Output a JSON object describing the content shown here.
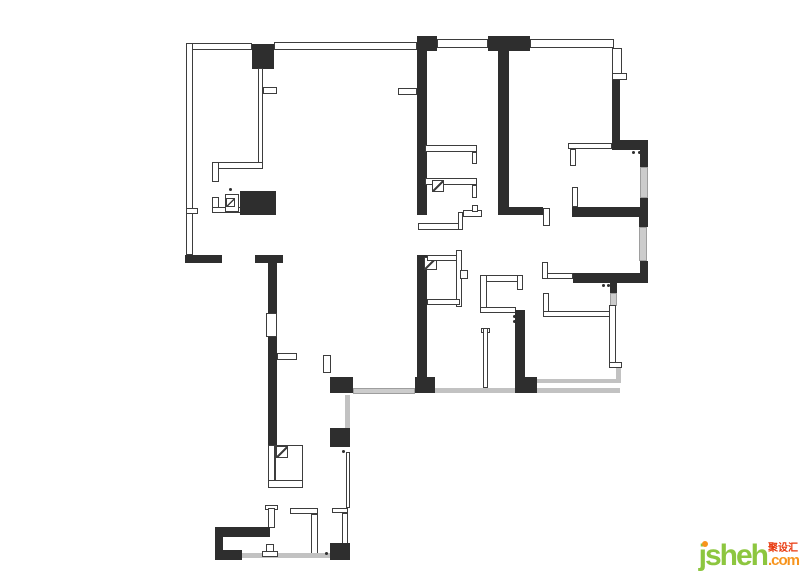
{
  "meta": {
    "width": 800,
    "height": 571,
    "background": "#ffffff",
    "description": "apartment floor plan drawing"
  },
  "floorplan": {
    "colors": {
      "wall": "#2e2e2e",
      "thin_border": "#3d3d3d",
      "window_fill": "#cccccc",
      "window_border": "#9e9e9e",
      "line": "#c2c2c2"
    },
    "shapes": [
      {
        "x": 186,
        "y": 43,
        "w": 66,
        "h": 7,
        "t": "t"
      },
      {
        "x": 186,
        "y": 43,
        "w": 7,
        "h": 212,
        "t": "t"
      },
      {
        "x": 186,
        "y": 208,
        "w": 12,
        "h": 6,
        "t": "t"
      },
      {
        "x": 252,
        "y": 44,
        "w": 22,
        "h": 25,
        "t": "b"
      },
      {
        "x": 274,
        "y": 42,
        "w": 143,
        "h": 8,
        "t": "t"
      },
      {
        "x": 417,
        "y": 36,
        "w": 20,
        "h": 15,
        "t": "b"
      },
      {
        "x": 417,
        "y": 51,
        "w": 10,
        "h": 164,
        "t": "b"
      },
      {
        "x": 437,
        "y": 39,
        "w": 51,
        "h": 9,
        "t": "t"
      },
      {
        "x": 488,
        "y": 36,
        "w": 42,
        "h": 15,
        "t": "b"
      },
      {
        "x": 498,
        "y": 51,
        "w": 11,
        "h": 156,
        "t": "b"
      },
      {
        "x": 530,
        "y": 39,
        "w": 84,
        "h": 9,
        "t": "t"
      },
      {
        "x": 612,
        "y": 48,
        "w": 10,
        "h": 26,
        "t": "t"
      },
      {
        "x": 612,
        "y": 73,
        "w": 15,
        "h": 7,
        "t": "t"
      },
      {
        "x": 612,
        "y": 80,
        "w": 8,
        "h": 61,
        "t": "b"
      },
      {
        "x": 612,
        "y": 140,
        "w": 36,
        "h": 10,
        "t": "b"
      },
      {
        "x": 568,
        "y": 143,
        "w": 44,
        "h": 6,
        "t": "t"
      },
      {
        "x": 570,
        "y": 149,
        "w": 6,
        "h": 17,
        "t": "t"
      },
      {
        "x": 632,
        "y": 151,
        "w": 3,
        "h": 3,
        "t": "dot"
      },
      {
        "x": 638,
        "y": 151,
        "w": 3,
        "h": 3,
        "t": "dot"
      },
      {
        "x": 640,
        "y": 150,
        "w": 8,
        "h": 17,
        "t": "b"
      },
      {
        "x": 640,
        "y": 167,
        "w": 8,
        "h": 31,
        "t": "w"
      },
      {
        "x": 640,
        "y": 198,
        "w": 8,
        "h": 19,
        "t": "b"
      },
      {
        "x": 572,
        "y": 187,
        "w": 6,
        "h": 20,
        "t": "t"
      },
      {
        "x": 572,
        "y": 207,
        "w": 76,
        "h": 10,
        "t": "b"
      },
      {
        "x": 498,
        "y": 207,
        "w": 45,
        "h": 8,
        "t": "b"
      },
      {
        "x": 543,
        "y": 208,
        "w": 7,
        "h": 18,
        "t": "t"
      },
      {
        "x": 639,
        "y": 217,
        "w": 9,
        "h": 10,
        "t": "b"
      },
      {
        "x": 639,
        "y": 227,
        "w": 8,
        "h": 34,
        "t": "w"
      },
      {
        "x": 640,
        "y": 261,
        "w": 8,
        "h": 22,
        "t": "b"
      },
      {
        "x": 573,
        "y": 273,
        "w": 74,
        "h": 10,
        "t": "b"
      },
      {
        "x": 547,
        "y": 273,
        "w": 26,
        "h": 6,
        "t": "t"
      },
      {
        "x": 542,
        "y": 262,
        "w": 6,
        "h": 17,
        "t": "t"
      },
      {
        "x": 602,
        "y": 284,
        "w": 3,
        "h": 3,
        "t": "dot"
      },
      {
        "x": 607,
        "y": 284,
        "w": 3,
        "h": 3,
        "t": "dot"
      },
      {
        "x": 610,
        "y": 283,
        "w": 7,
        "h": 10,
        "t": "b"
      },
      {
        "x": 610,
        "y": 293,
        "w": 7,
        "h": 13,
        "t": "w"
      },
      {
        "x": 543,
        "y": 293,
        "w": 6,
        "h": 23,
        "t": "t"
      },
      {
        "x": 543,
        "y": 311,
        "w": 68,
        "h": 6,
        "t": "t"
      },
      {
        "x": 609,
        "y": 305,
        "w": 7,
        "h": 58,
        "t": "t"
      },
      {
        "x": 609,
        "y": 362,
        "w": 13,
        "h": 6,
        "t": "t"
      },
      {
        "x": 616,
        "y": 368,
        "w": 5,
        "h": 15,
        "t": "g"
      },
      {
        "x": 537,
        "y": 379,
        "w": 83,
        "h": 4,
        "t": "g"
      },
      {
        "x": 537,
        "y": 388,
        "w": 83,
        "h": 5,
        "t": "g"
      },
      {
        "x": 353,
        "y": 388,
        "w": 62,
        "h": 6,
        "t": "w"
      },
      {
        "x": 435,
        "y": 388,
        "w": 82,
        "h": 5,
        "t": "g"
      },
      {
        "x": 415,
        "y": 377,
        "w": 20,
        "h": 16,
        "t": "b"
      },
      {
        "x": 417,
        "y": 255,
        "w": 10,
        "h": 122,
        "t": "b"
      },
      {
        "x": 424,
        "y": 257,
        "w": 13,
        "h": 13,
        "t": "d"
      },
      {
        "x": 427,
        "y": 255,
        "w": 33,
        "h": 6,
        "t": "t"
      },
      {
        "x": 456,
        "y": 250,
        "w": 6,
        "h": 57,
        "t": "t"
      },
      {
        "x": 460,
        "y": 270,
        "w": 8,
        "h": 9,
        "t": "t"
      },
      {
        "x": 427,
        "y": 299,
        "w": 33,
        "h": 6,
        "t": "t"
      },
      {
        "x": 423,
        "y": 180,
        "w": 3,
        "h": 3,
        "t": "dot"
      },
      {
        "x": 423,
        "y": 185,
        "w": 3,
        "h": 3,
        "t": "dot"
      },
      {
        "x": 425,
        "y": 145,
        "w": 52,
        "h": 7,
        "t": "t"
      },
      {
        "x": 472,
        "y": 152,
        "w": 5,
        "h": 12,
        "t": "t"
      },
      {
        "x": 425,
        "y": 178,
        "w": 52,
        "h": 7,
        "t": "t"
      },
      {
        "x": 472,
        "y": 185,
        "w": 5,
        "h": 13,
        "t": "t"
      },
      {
        "x": 432,
        "y": 180,
        "w": 12,
        "h": 12,
        "t": "d"
      },
      {
        "x": 418,
        "y": 223,
        "w": 45,
        "h": 7,
        "t": "t"
      },
      {
        "x": 458,
        "y": 212,
        "w": 5,
        "h": 18,
        "t": "t"
      },
      {
        "x": 463,
        "y": 210,
        "w": 19,
        "h": 7,
        "t": "t"
      },
      {
        "x": 472,
        "y": 205,
        "w": 6,
        "h": 7,
        "t": "t"
      },
      {
        "x": 480,
        "y": 275,
        "w": 43,
        "h": 7,
        "t": "t"
      },
      {
        "x": 480,
        "y": 275,
        "w": 7,
        "h": 37,
        "t": "t"
      },
      {
        "x": 517,
        "y": 275,
        "w": 6,
        "h": 15,
        "t": "t"
      },
      {
        "x": 480,
        "y": 307,
        "w": 36,
        "h": 6,
        "t": "t"
      },
      {
        "x": 515,
        "y": 310,
        "w": 10,
        "h": 67,
        "t": "b"
      },
      {
        "x": 513,
        "y": 315,
        "w": 3,
        "h": 3,
        "t": "dot"
      },
      {
        "x": 513,
        "y": 320,
        "w": 3,
        "h": 3,
        "t": "dot"
      },
      {
        "x": 515,
        "y": 377,
        "w": 22,
        "h": 16,
        "t": "b"
      },
      {
        "x": 481,
        "y": 328,
        "w": 9,
        "h": 5,
        "t": "t"
      },
      {
        "x": 483,
        "y": 328,
        "w": 5,
        "h": 60,
        "t": "t"
      },
      {
        "x": 330,
        "y": 377,
        "w": 23,
        "h": 16,
        "t": "b"
      },
      {
        "x": 323,
        "y": 355,
        "w": 8,
        "h": 18,
        "t": "t"
      },
      {
        "x": 185,
        "y": 255,
        "w": 37,
        "h": 8,
        "t": "b"
      },
      {
        "x": 255,
        "y": 255,
        "w": 28,
        "h": 8,
        "t": "b"
      },
      {
        "x": 268,
        "y": 263,
        "w": 9,
        "h": 50,
        "t": "b"
      },
      {
        "x": 266,
        "y": 313,
        "w": 11,
        "h": 24,
        "t": "t"
      },
      {
        "x": 268,
        "y": 337,
        "w": 9,
        "h": 110,
        "t": "b"
      },
      {
        "x": 277,
        "y": 353,
        "w": 20,
        "h": 7,
        "t": "t"
      },
      {
        "x": 258,
        "y": 68,
        "w": 5,
        "h": 95,
        "t": "t"
      },
      {
        "x": 263,
        "y": 87,
        "w": 14,
        "h": 7,
        "t": "t"
      },
      {
        "x": 398,
        "y": 88,
        "w": 19,
        "h": 7,
        "t": "t"
      },
      {
        "x": 212,
        "y": 162,
        "w": 51,
        "h": 7,
        "t": "t"
      },
      {
        "x": 212,
        "y": 162,
        "w": 7,
        "h": 20,
        "t": "t"
      },
      {
        "x": 212,
        "y": 197,
        "w": 7,
        "h": 16,
        "t": "t"
      },
      {
        "x": 212,
        "y": 207,
        "w": 30,
        "h": 6,
        "t": "t"
      },
      {
        "x": 225,
        "y": 194,
        "w": 14,
        "h": 18,
        "t": "t"
      },
      {
        "x": 226,
        "y": 198,
        "w": 9,
        "h": 9,
        "t": "d"
      },
      {
        "x": 229,
        "y": 188,
        "w": 3,
        "h": 3,
        "t": "dot"
      },
      {
        "x": 240,
        "y": 191,
        "w": 36,
        "h": 24,
        "t": "b"
      },
      {
        "x": 345,
        "y": 395,
        "w": 5,
        "h": 33,
        "t": "g"
      },
      {
        "x": 330,
        "y": 428,
        "w": 20,
        "h": 19,
        "t": "b"
      },
      {
        "x": 342,
        "y": 450,
        "w": 3,
        "h": 3,
        "t": "dot"
      },
      {
        "x": 346,
        "y": 452,
        "w": 4,
        "h": 56,
        "t": "t"
      },
      {
        "x": 332,
        "y": 508,
        "w": 16,
        "h": 5,
        "t": "t"
      },
      {
        "x": 342,
        "y": 513,
        "w": 6,
        "h": 31,
        "t": "t"
      },
      {
        "x": 330,
        "y": 543,
        "w": 20,
        "h": 17,
        "t": "b"
      },
      {
        "x": 290,
        "y": 508,
        "w": 28,
        "h": 6,
        "t": "t"
      },
      {
        "x": 311,
        "y": 514,
        "w": 7,
        "h": 44,
        "t": "t"
      },
      {
        "x": 268,
        "y": 445,
        "w": 7,
        "h": 43,
        "t": "t"
      },
      {
        "x": 275,
        "y": 445,
        "w": 28,
        "h": 36,
        "t": "t"
      },
      {
        "x": 276,
        "y": 446,
        "w": 12,
        "h": 12,
        "t": "d"
      },
      {
        "x": 268,
        "y": 480,
        "w": 35,
        "h": 8,
        "t": "t"
      },
      {
        "x": 265,
        "y": 505,
        "w": 13,
        "h": 5,
        "t": "t"
      },
      {
        "x": 268,
        "y": 508,
        "w": 7,
        "h": 20,
        "t": "t"
      },
      {
        "x": 215,
        "y": 527,
        "w": 55,
        "h": 10,
        "t": "b"
      },
      {
        "x": 215,
        "y": 527,
        "w": 8,
        "h": 33,
        "t": "b"
      },
      {
        "x": 215,
        "y": 550,
        "w": 27,
        "h": 10,
        "t": "b"
      },
      {
        "x": 242,
        "y": 553,
        "w": 88,
        "h": 5,
        "t": "g"
      },
      {
        "x": 325,
        "y": 552,
        "w": 3,
        "h": 3,
        "t": "dot"
      },
      {
        "x": 266,
        "y": 544,
        "w": 8,
        "h": 9,
        "t": "t"
      },
      {
        "x": 262,
        "y": 551,
        "w": 16,
        "h": 6,
        "t": "t"
      }
    ]
  },
  "logo": {
    "text": "jsheh",
    "cn": "聚设汇",
    "com": ".com",
    "green": "#8dc63f",
    "orange": "#f7941d",
    "red": "#e8380d"
  }
}
